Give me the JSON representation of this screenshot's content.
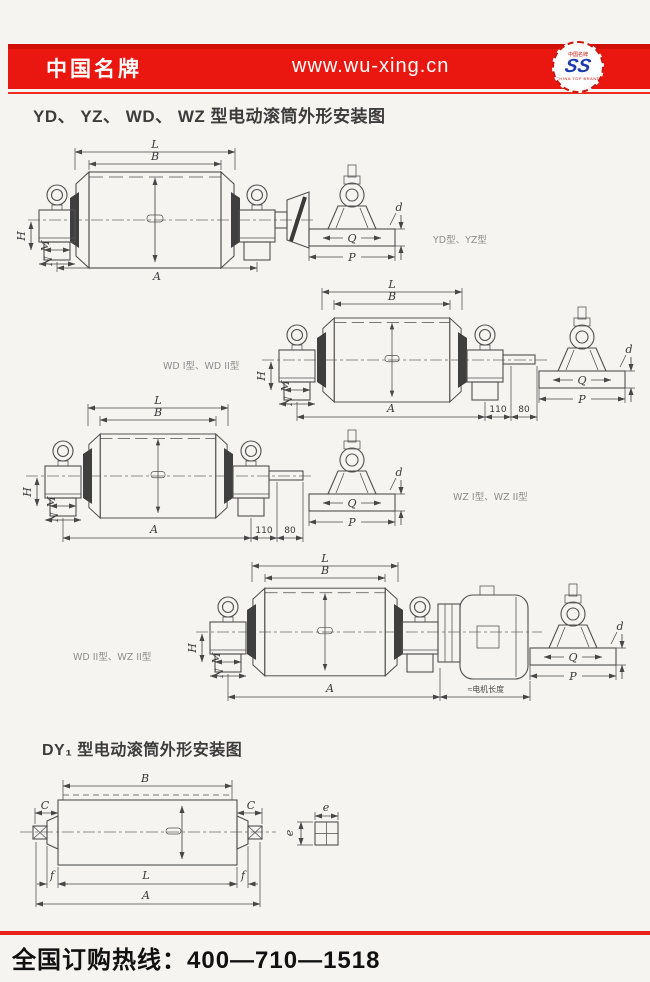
{
  "header": {
    "brand": "中国名牌",
    "url": "www.wu-xing.cn",
    "logo_top": "中国名牌",
    "logo_glyph": "SS",
    "logo_bottom": "CHINA TOP BRAND"
  },
  "titles": {
    "main": "YD、 YZ、 WD、 WZ 型电动滚筒外形安装图",
    "dy": "DY₁ 型电动滚筒外形安装图"
  },
  "variant_labels": {
    "row1": "YD型、YZ型",
    "row2": "WD I型、WD II型",
    "row3": "WZ I型、WZ II型",
    "row4": "WD II型、WZ II型"
  },
  "dims": {
    "L": "L",
    "B": "B",
    "A": "A",
    "H": "H",
    "M": "M",
    "N": "N",
    "Q": "Q",
    "P": "P",
    "d": "d",
    "C": "C",
    "f": "f",
    "e": "e"
  },
  "nums": {
    "n110": "110",
    "n80": "80"
  },
  "notes": {
    "motor_length": "≈电机长度"
  },
  "footer": {
    "hotline": "全国订购热线：400—710—1518"
  }
}
